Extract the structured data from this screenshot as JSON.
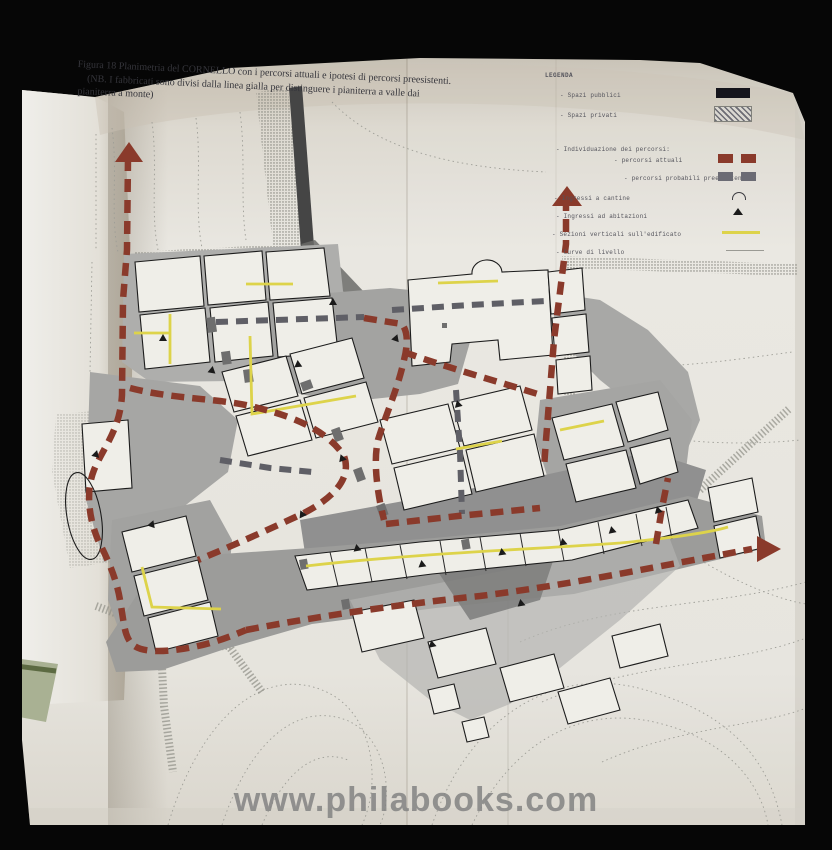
{
  "photo": {
    "kind": "book-page-photograph",
    "subject": "Planimetria del Cornello"
  },
  "caption": {
    "line1": "Figura 18 Planimetria del CORNELLO con i percorsi attuali e ipotesi di percorsi preesistenti.",
    "line2": "(NB. I fabbricati sono divisi dalla linea gialla per distinguere i pianiterra a valle dai",
    "line3": "pianiterra a monte)"
  },
  "legend": {
    "title": "LEGENDA",
    "items": [
      {
        "label": "- Spazi pubblici",
        "symbol": "solid-black"
      },
      {
        "label": "- Spazi privati",
        "symbol": "hatched"
      },
      {
        "label": "- Individuazione dei percorsi:",
        "symbol": "none"
      },
      {
        "label": "- percorsi attuali",
        "symbol": "red-dashes"
      },
      {
        "label": "- percorsi probabili preesistenti",
        "symbol": "gray-dashes"
      },
      {
        "label": "- Ingressi a cantine",
        "symbol": "arch"
      },
      {
        "label": "- Ingressi ad abitazioni",
        "symbol": "triangle"
      },
      {
        "label": "- Sezioni verticali sull'edificato",
        "symbol": "yellow-line"
      },
      {
        "label": "- Curve di livello",
        "symbol": "gray-line"
      }
    ]
  },
  "watermark": {
    "text": "www.philabooks.com"
  },
  "map": {
    "place": "CORNELLO",
    "colors": {
      "percorsi_attuali": "#8a3a2b",
      "percorsi_preesistenti": "#63636b",
      "sezioni_verticali": "#ddd34a",
      "spazi_pubblici": "#15151c",
      "contour": "#9a9a94",
      "page": "#e6e4dd",
      "shaded_space": "#a3a3a1"
    }
  }
}
